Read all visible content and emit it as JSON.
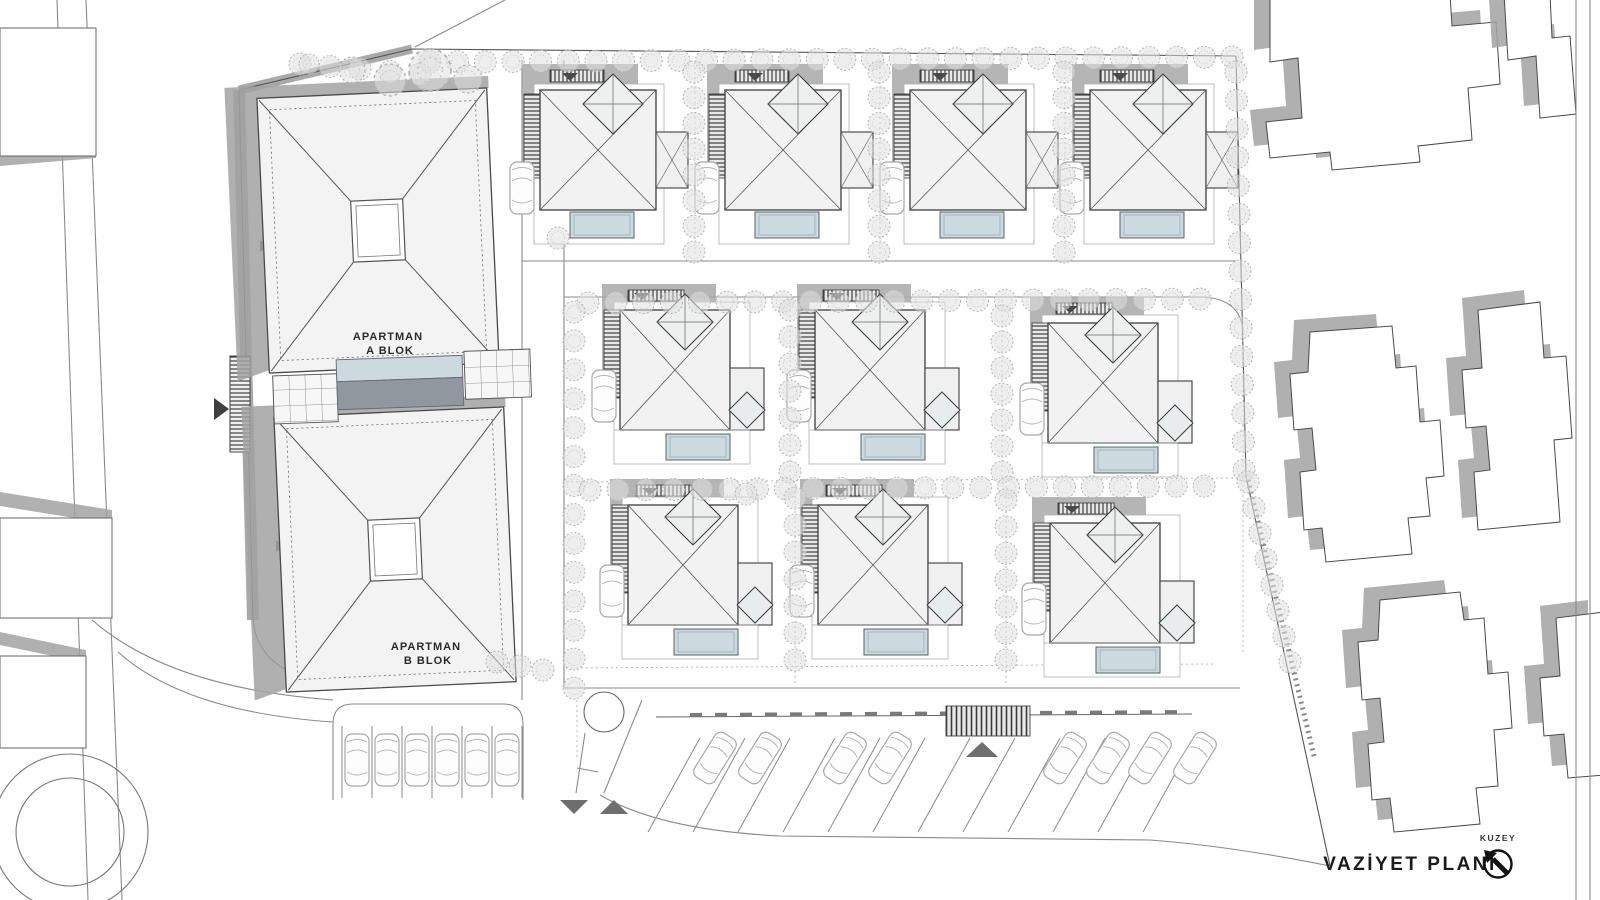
{
  "title_block": {
    "north_label": "KUZEY",
    "plan_label": "VAZİYET PLANI"
  },
  "apartment_blocks": {
    "a": {
      "line1": "APARTMAN",
      "line2": "A BLOK"
    },
    "b": {
      "line1": "APARTMAN",
      "line2": "B BLOK"
    }
  },
  "colors": {
    "shadow": "#a2a2a2",
    "roof_fill": "#f2f2f2",
    "roof_stroke": "#3d3d3d",
    "pool": "#ccd9df",
    "pool_shadow": "#8f989e",
    "tree_fill": "#e0e0e0",
    "tree_stroke": "#b5b5b5",
    "line": "#555555",
    "marker_dark": "#4a4a4a"
  },
  "villas": {
    "count": 10,
    "rows": [
      4,
      3,
      3
    ],
    "items": [
      {
        "variant": "top",
        "x": 518,
        "y": 58
      },
      {
        "variant": "top",
        "x": 703,
        "y": 58
      },
      {
        "variant": "top",
        "x": 888,
        "y": 58
      },
      {
        "variant": "top",
        "x": 1068,
        "y": 58
      },
      {
        "variant": "mid",
        "x": 600,
        "y": 272
      },
      {
        "variant": "mid",
        "x": 795,
        "y": 272
      },
      {
        "variant": "mid",
        "x": 1028,
        "y": 285
      },
      {
        "variant": "mid",
        "x": 608,
        "y": 467
      },
      {
        "variant": "mid",
        "x": 798,
        "y": 467
      },
      {
        "variant": "mid",
        "x": 1030,
        "y": 485
      }
    ]
  },
  "landscape": {
    "hedges": [
      {
        "x1": 430,
        "y1": 62,
        "x2": 1232,
        "y2": 57,
        "n": 30
      },
      {
        "x1": 300,
        "y1": 64,
        "x2": 420,
        "y2": 74,
        "n": 5
      },
      {
        "x1": 1236,
        "y1": 72,
        "x2": 1244,
        "y2": 470,
        "n": 15
      },
      {
        "x1": 1248,
        "y1": 482,
        "x2": 1290,
        "y2": 662,
        "n": 8
      },
      {
        "x1": 694,
        "y1": 72,
        "x2": 694,
        "y2": 252,
        "n": 8
      },
      {
        "x1": 879,
        "y1": 72,
        "x2": 879,
        "y2": 252,
        "n": 8
      },
      {
        "x1": 1064,
        "y1": 72,
        "x2": 1064,
        "y2": 252,
        "n": 8
      },
      {
        "x1": 588,
        "y1": 303,
        "x2": 1200,
        "y2": 299,
        "n": 23
      },
      {
        "x1": 574,
        "y1": 312,
        "x2": 574,
        "y2": 688,
        "n": 14
      },
      {
        "x1": 790,
        "y1": 310,
        "x2": 790,
        "y2": 472,
        "n": 7
      },
      {
        "x1": 1002,
        "y1": 316,
        "x2": 1002,
        "y2": 472,
        "n": 7
      },
      {
        "x1": 590,
        "y1": 490,
        "x2": 1204,
        "y2": 486,
        "n": 23
      },
      {
        "x1": 795,
        "y1": 498,
        "x2": 795,
        "y2": 660,
        "n": 7
      },
      {
        "x1": 1006,
        "y1": 500,
        "x2": 1006,
        "y2": 660,
        "n": 7
      },
      {
        "x1": 497,
        "y1": 662,
        "x2": 543,
        "y2": 670,
        "n": 3
      }
    ],
    "bushes": [
      [
        430,
        70,
        21
      ],
      [
        468,
        79,
        14
      ],
      [
        352,
        70,
        13
      ],
      [
        309,
        64,
        10
      ],
      [
        390,
        80,
        16
      ],
      [
        558,
        238,
        11
      ],
      [
        746,
        494,
        11
      ]
    ]
  },
  "parking": {
    "west": {
      "stalls": 6,
      "car_x": [
        357,
        387,
        417,
        447,
        477,
        507
      ],
      "car_y": 760
    },
    "south": {
      "stall_count": 12,
      "first_x": 700,
      "spacing": 45,
      "top_y": 738,
      "bottom_dx": -52,
      "bottom_y": 832,
      "car_x": [
        715,
        760,
        845,
        890,
        1065,
        1108,
        1150,
        1195
      ],
      "car_y": 758,
      "car_angle": 32
    }
  },
  "neighbors": {
    "right": [
      {
        "d": "M1270,-6 L1270,62 L1298,58 L1302,118 L1266,122 L1270,158 L1330,152 L1332,170 L1420,162 L1418,146 L1472,140 L1468,88 L1500,84 L1496,22 L1452,26 L1450,-6 Z"
      },
      {
        "d": "M1504,-6 L1508,60 L1536,56 L1540,118 L1576,114 L1570,36 L1552,38 L1550,-6 Z"
      },
      {
        "d": "M1310,332 L1308,372 L1290,374 L1294,430 L1312,428 L1316,470 L1300,472 L1304,530 L1322,528 L1326,562 L1412,554 L1408,518 L1430,516 L1426,478 L1444,476 L1440,420 L1420,422 L1416,366 L1396,368 L1392,326 Z"
      },
      {
        "d": "M1478,310 L1482,368 L1462,370 L1466,428 L1486,426 L1490,470 L1474,472 L1478,530 L1560,522 L1554,440 L1572,438 L1566,356 L1544,358 L1540,302 Z"
      },
      {
        "d": "M1380,600 L1378,640 L1358,642 L1362,700 L1380,698 L1384,742 L1368,744 L1372,800 L1390,798 L1394,832 L1480,824 L1476,788 L1498,786 L1494,730 L1512,728 L1508,672 L1488,674 L1484,618 L1464,620 L1460,592 Z"
      },
      {
        "d": "M1556,618 L1560,676 L1540,678 L1544,736 L1564,734 L1568,778 L1604,775 L1604,612 Z"
      }
    ],
    "left": [
      {
        "x": 0,
        "y": 28,
        "w": 96,
        "h": 128,
        "shadow_d": "M0,150 L96,144 L96,158 L0,166 Z"
      },
      {
        "x": 0,
        "y": 518,
        "w": 112,
        "h": 100,
        "shadow_d": "M0,492 L112,510 L112,524 L0,506 Z"
      },
      {
        "x": 0,
        "y": 656,
        "w": 86,
        "h": 92,
        "shadow_d": "M0,632 L86,650 L86,663 L0,645 Z"
      }
    ]
  }
}
